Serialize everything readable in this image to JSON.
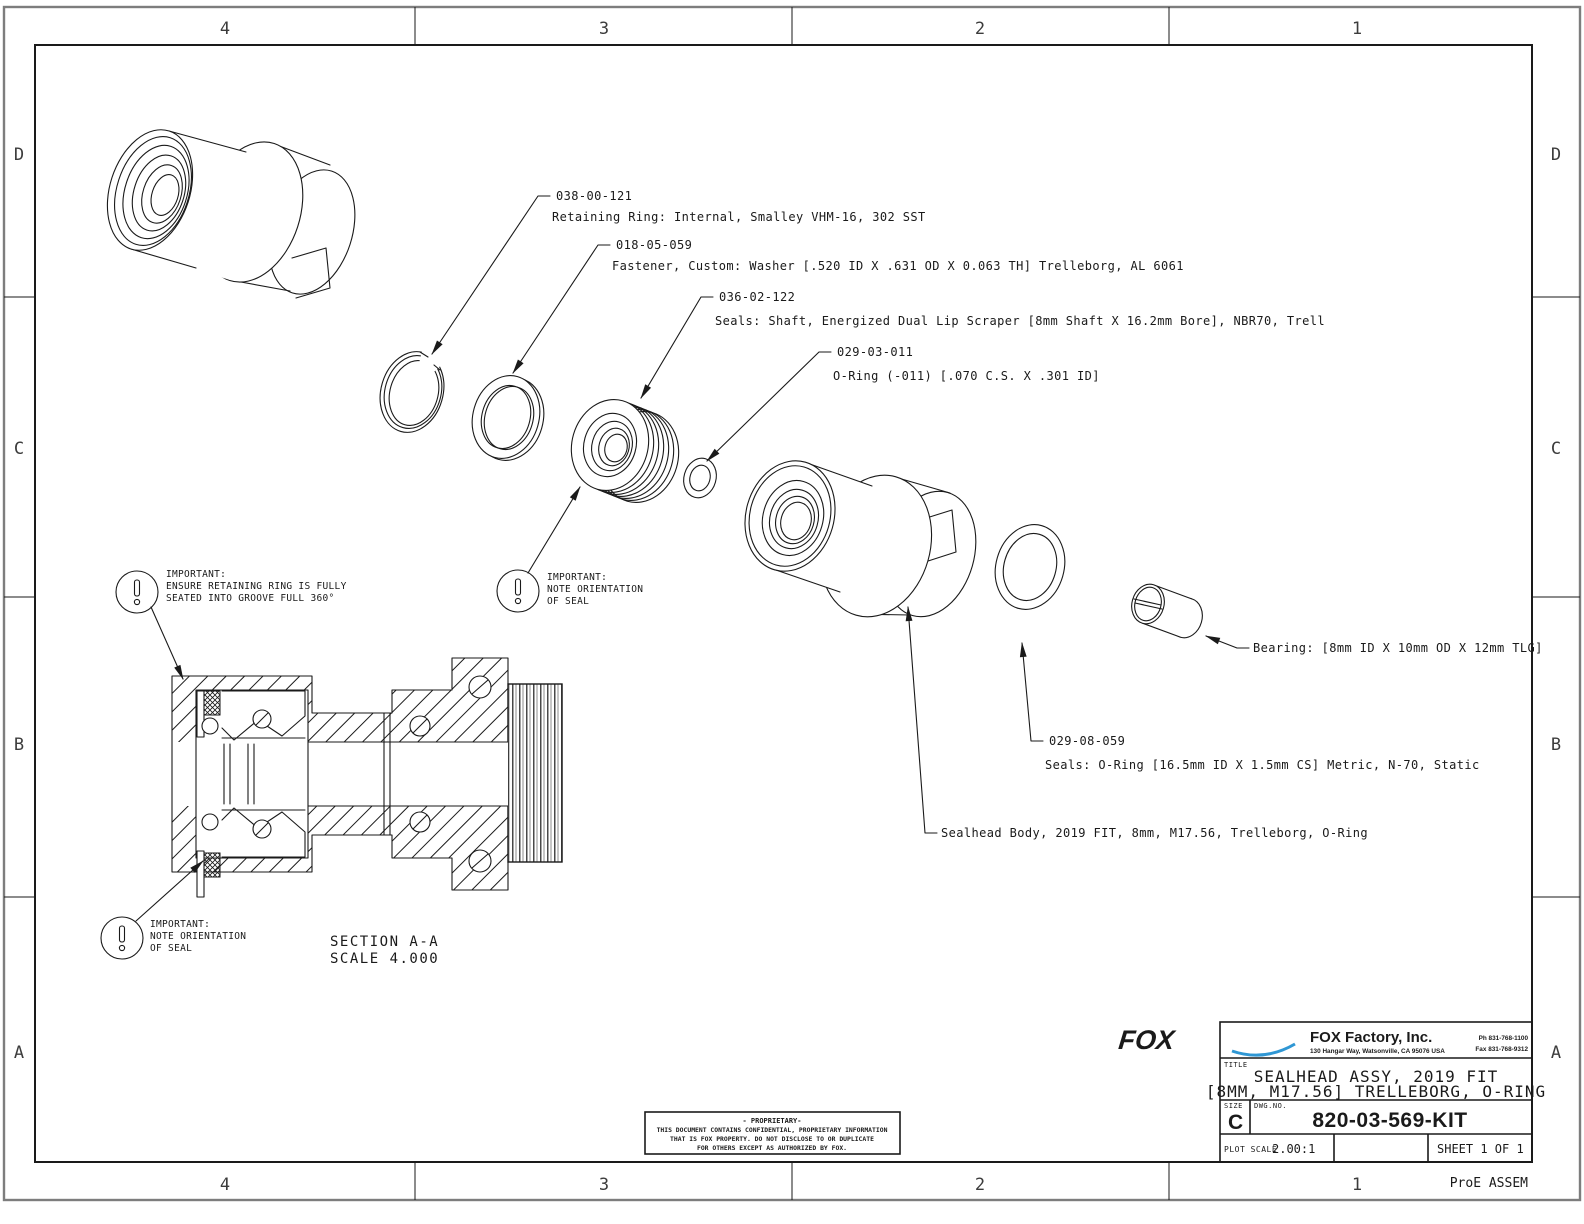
{
  "sheet": {
    "zones_horizontal": [
      "4",
      "3",
      "2",
      "1"
    ],
    "zones_vertical": [
      "D",
      "C",
      "B",
      "A"
    ],
    "footer_note": "ProE ASSEM"
  },
  "callouts": [
    {
      "part_no": "038-00-121",
      "desc": "Retaining Ring: Internal, Smalley VHM-16, 302 SST"
    },
    {
      "part_no": "018-05-059",
      "desc": "Fastener, Custom: Washer [.520 ID X .631 OD X 0.063 TH] Trelleborg, AL 6061"
    },
    {
      "part_no": "036-02-122",
      "desc": "Seals: Shaft, Energized Dual Lip Scraper [8mm Shaft X 16.2mm Bore], NBR70, Trell"
    },
    {
      "part_no": "029-03-011",
      "desc": "O-Ring (-011) [.070 C.S. X .301 ID]"
    },
    {
      "part_no": "029-08-059",
      "desc": "Seals: O-Ring [16.5mm ID X 1.5mm CS] Metric, N-70, Static"
    },
    {
      "part_no": "",
      "desc": "Bearing: [8mm ID X 10mm OD X 12mm TLG]"
    },
    {
      "part_no": "",
      "desc": "Sealhead Body, 2019 FIT, 8mm, M17.56, Trelleborg, O-Ring"
    }
  ],
  "notes": [
    {
      "lines": [
        "IMPORTANT:",
        "ENSURE RETAINING RING IS FULLY",
        "SEATED INTO GROOVE FULL 360°"
      ]
    },
    {
      "lines": [
        "IMPORTANT:",
        "NOTE ORIENTATION",
        "OF SEAL"
      ]
    },
    {
      "lines": [
        "IMPORTANT:",
        "NOTE ORIENTATION",
        "OF SEAL"
      ]
    }
  ],
  "section": {
    "label": "SECTION  A-A",
    "scale": "SCALE  4.000"
  },
  "title_block": {
    "logo": "FOX",
    "company": "FOX Factory, Inc.",
    "address": "130 Hangar Way, Watsonville, CA 95076 USA",
    "phone": "Ph 831-768-1100",
    "fax": "Fax 831-768-9312",
    "title_label": "TITLE",
    "title_line1": "SEALHEAD ASSY, 2019 FIT",
    "title_line2": "[8MM, M17.56] TRELLEBORG, O-RING",
    "size_label": "SIZE",
    "size": "C",
    "dwg_label": "DWG.NO.",
    "dwg_no": "820-03-569-KIT",
    "plot_scale_label": "PLOT SCALE",
    "plot_scale": "2.00:1",
    "sheet": "SHEET 1 OF 1"
  },
  "proprietary": {
    "line1": "- PROPRIETARY-",
    "line2": "THIS DOCUMENT CONTAINS CONFIDENTIAL, PROPRIETARY INFORMATION",
    "line3": "THAT IS FOX PROPERTY.  DO NOT DISCLOSE TO OR DUPLICATE",
    "line4": "FOR OTHERS EXCEPT AS AUTHORIZED BY FOX."
  },
  "colors": {
    "line": "#1a1a1a",
    "logo_blue": "#2f97d4",
    "border_gray": "#7d7d7d"
  }
}
